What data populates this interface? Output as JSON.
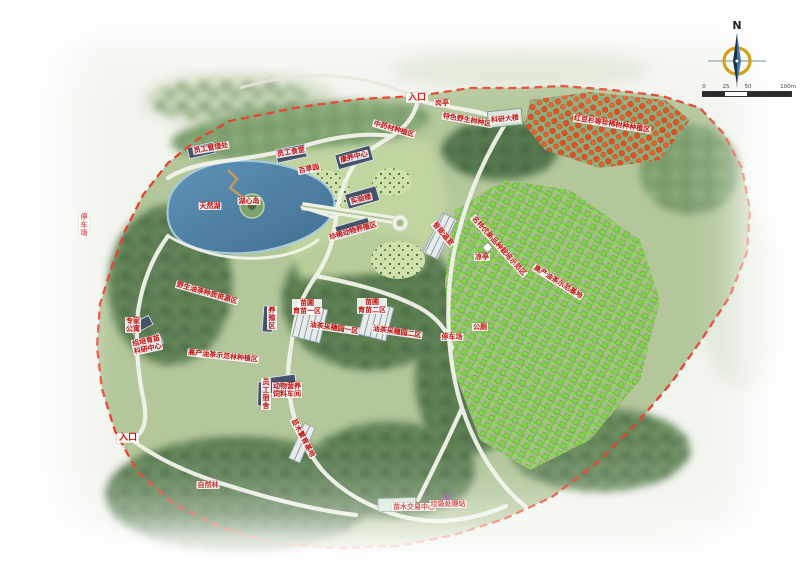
{
  "page": {
    "background": "#f2f4ee"
  },
  "compass": {
    "north_label": "N"
  },
  "scale_bar": {
    "ticks": [
      "0",
      "25",
      "50",
      "100m"
    ]
  },
  "map": {
    "boundary_color": "#e8402e",
    "lake_color": "#4f82a6",
    "orchard_color": "#7fd24a",
    "red_tree_color": "#e64e1f",
    "labels": [
      {
        "text": "入口",
        "x": 417,
        "y": 98,
        "entrance": true,
        "name": "label-entrance-north"
      },
      {
        "text": "岗亭",
        "x": 442,
        "y": 103,
        "name": "label-guard-post"
      },
      {
        "text": "员工管理处",
        "x": 211,
        "y": 148,
        "rot": -10,
        "name": "label-staff-office"
      },
      {
        "text": "员工食堂",
        "x": 291,
        "y": 152,
        "rot": -10,
        "name": "label-staff-canteen"
      },
      {
        "text": "康养中心",
        "x": 354,
        "y": 157,
        "rot": -14,
        "name": "label-wellness-center"
      },
      {
        "text": "百草园",
        "x": 309,
        "y": 169,
        "rot": -12,
        "name": "label-herb-garden"
      },
      {
        "text": "实验楼",
        "x": 361,
        "y": 199,
        "rot": -14,
        "name": "label-lab-building"
      },
      {
        "text": "珍稀动物养殖区",
        "x": 353,
        "y": 231,
        "rot": -16,
        "name": "label-rare-animal-area"
      },
      {
        "text": "湖心岛",
        "x": 249,
        "y": 201,
        "name": "label-lake-island"
      },
      {
        "text": "天然湖",
        "x": 210,
        "y": 206,
        "name": "label-natural-lake"
      },
      {
        "text": "中药材种植区",
        "x": 394,
        "y": 129,
        "rot": 16,
        "name": "label-medicinal-area"
      },
      {
        "text": "特色野生树种区",
        "x": 467,
        "y": 120,
        "rot": 10,
        "name": "label-wild-species-area"
      },
      {
        "text": "科研大楼",
        "x": 505,
        "y": 119,
        "rot": -6,
        "name": "label-research-building"
      },
      {
        "text": "红豆杉等珍稀树种种植区",
        "x": 612,
        "y": 124,
        "rot": 9,
        "name": "label-rare-tree-plantation"
      },
      {
        "text": "野生油茶种质资源区",
        "x": 207,
        "y": 293,
        "rot": 16,
        "name": "label-wild-germplasm-area"
      },
      {
        "lines": [
          "专家",
          "公寓"
        ],
        "x": 133,
        "y": 325,
        "name": "label-expert-apartment"
      },
      {
        "lines": [
          "组培育苗",
          "科研中心"
        ],
        "x": 147,
        "y": 345,
        "rot": -12,
        "name": "label-tissue-culture-center"
      },
      {
        "text": "高产油茶示范林种植区",
        "x": 223,
        "y": 356,
        "rot": 6,
        "name": "label-demo-forest-area"
      },
      {
        "text": "养殖区",
        "x": 272,
        "y": 318,
        "vertical": true,
        "name": "label-breeding-area"
      },
      {
        "lines": [
          "苗圃",
          "育苗一区"
        ],
        "x": 307,
        "y": 307,
        "name": "label-nursery-1"
      },
      {
        "lines": [
          "苗圃",
          "育苗二区"
        ],
        "x": 372,
        "y": 306,
        "name": "label-nursery-2"
      },
      {
        "text": "油茶采穗园一区",
        "x": 334,
        "y": 328,
        "rot": 8,
        "name": "label-scion-garden-1"
      },
      {
        "text": "油茶采穗园二区",
        "x": 397,
        "y": 332,
        "rot": 8,
        "name": "label-scion-garden-2"
      },
      {
        "text": "员工宿舍",
        "x": 266,
        "y": 394,
        "vertical": true,
        "name": "label-staff-dorm"
      },
      {
        "lines": [
          "动物营养",
          "饲料车间"
        ],
        "x": 287,
        "y": 390,
        "name": "label-feed-workshop"
      },
      {
        "text": "苗木繁育基地",
        "x": 303,
        "y": 438,
        "rot": 62,
        "name": "label-seedling-base"
      },
      {
        "text": "入口",
        "x": 128,
        "y": 438,
        "entrance": true,
        "name": "label-entrance-west"
      },
      {
        "text": "自然林",
        "x": 208,
        "y": 485,
        "name": "label-natural-forest"
      },
      {
        "text": "苗木交易中心",
        "x": 414,
        "y": 507,
        "name": "label-seedling-market"
      },
      {
        "text": "垃圾处理站",
        "x": 448,
        "y": 504,
        "name": "label-waste-station"
      },
      {
        "text": "智能温室",
        "x": 443,
        "y": 234,
        "rot": 50,
        "name": "label-greenhouse"
      },
      {
        "text": "名特优新品种栽培示范区",
        "x": 499,
        "y": 246,
        "rot": 48,
        "name": "label-new-variety-area"
      },
      {
        "text": "凉亭",
        "x": 482,
        "y": 257,
        "name": "label-pavilion"
      },
      {
        "text": "公厕",
        "x": 480,
        "y": 327,
        "name": "label-toilet"
      },
      {
        "text": "停车场",
        "x": 452,
        "y": 337,
        "name": "label-parking-east"
      },
      {
        "text": "高产油茶示范基地",
        "x": 558,
        "y": 282,
        "rot": 32,
        "name": "label-demo-base"
      },
      {
        "text": "停车场",
        "x": 84,
        "y": 225,
        "vertical": true,
        "name": "label-parking-west"
      }
    ]
  }
}
